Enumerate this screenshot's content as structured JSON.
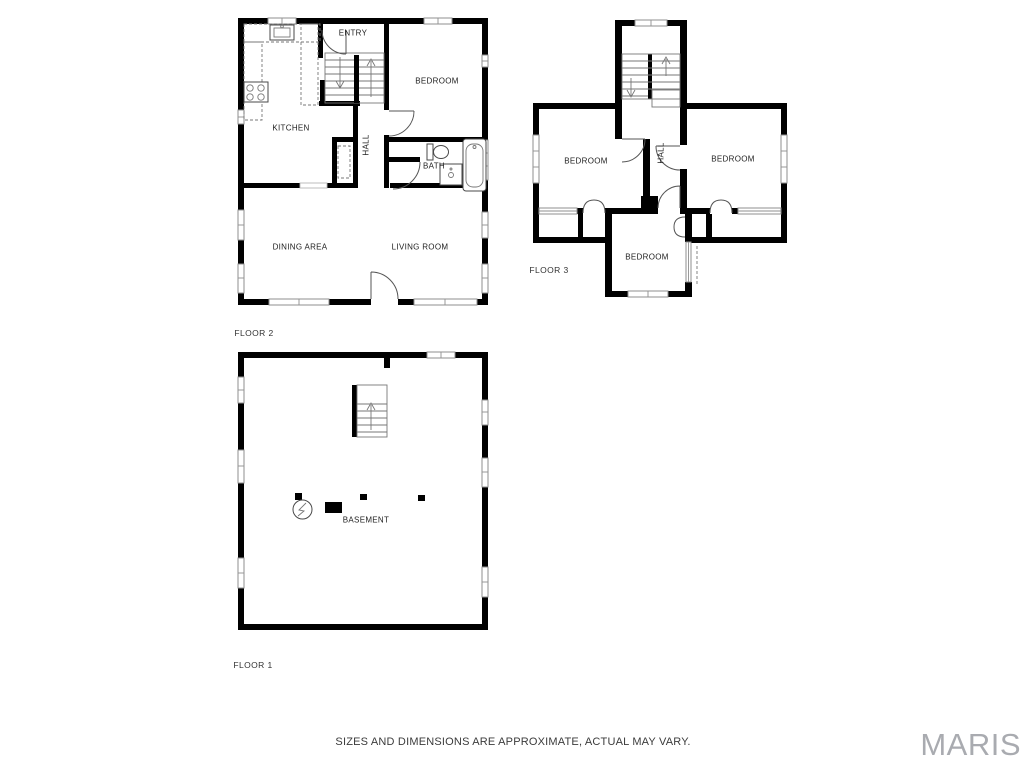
{
  "page": {
    "disclaimer": "SIZES AND DIMENSIONS ARE APPROXIMATE, ACTUAL MAY VARY.",
    "watermark": "MARIS"
  },
  "floor2": {
    "label": "FLOOR 2",
    "rooms": {
      "kitchen": "KITCHEN",
      "entry": "ENTRY",
      "bedroom": "BEDROOM",
      "hall": "HALL",
      "bath": "BATH",
      "dining": "DINING AREA",
      "living": "LIVING ROOM"
    }
  },
  "floor3": {
    "label": "FLOOR 3",
    "rooms": {
      "bedroom_left": "BEDROOM",
      "bedroom_right": "BEDROOM",
      "bedroom_lower": "BEDROOM",
      "hall": "HALL"
    }
  },
  "floor1": {
    "label": "FLOOR 1",
    "rooms": {
      "basement": "BASEMENT"
    }
  },
  "colors": {
    "wall": "#000000",
    "window_line": "#8f8f8f",
    "fixture_line": "#4a4a4a",
    "label_text": "#222222",
    "watermark": "#a9abb0"
  }
}
